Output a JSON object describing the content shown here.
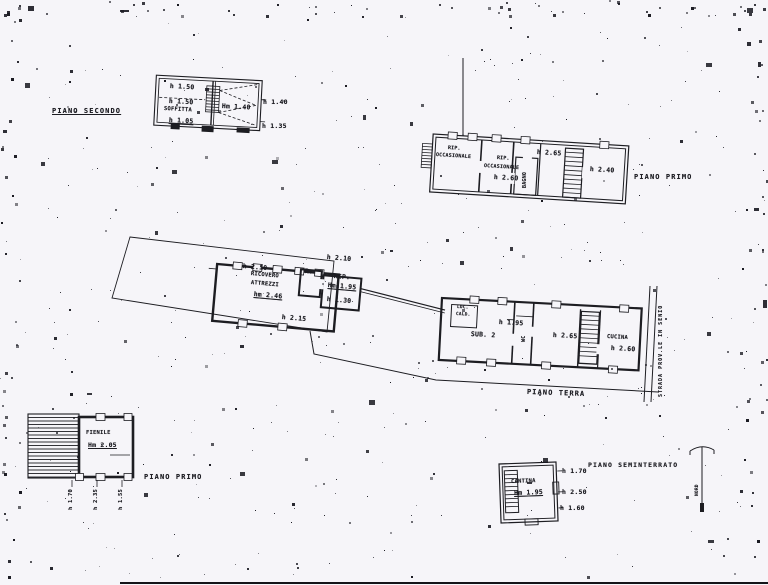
{
  "plans": {
    "secondo": {
      "title": "PIANO SECONDO",
      "soffitta": "SOFFITTA",
      "dim_top": "h 1.50",
      "dim_mid": "h 1.50",
      "dim_low": "h 1.05",
      "dim_hm": "Hm 1.40",
      "dim_right": "h 1.40",
      "dim_right_low": "h 1.35"
    },
    "primo": {
      "title": "PIANO PRIMO",
      "rip1_line1": "RIP.",
      "rip1_line2": "OCCASIONALE",
      "rip2_line1": "RIP.",
      "rip2_line2": "OCCASIONALE",
      "rip2_h": "h 2.60",
      "dim_265": "h 2.65",
      "bagno": "BAGNO",
      "dim_240": "h 2.40"
    },
    "terra": {
      "title": "PIANO TERRA",
      "dim_210_left": "h 2.10",
      "ricovero_line1": "RICOVERO",
      "ricovero_line2": "ATTREZZI",
      "ricovero_h": "hm 2.46",
      "room_r": "R.",
      "dim_210_right": "h 2.10",
      "rip": "RIP.",
      "rip_h": "Hm 1.95",
      "dim_130": "h 1.30",
      "dim_215": "h 2.15",
      "loc_line1": "LOC.",
      "loc_line2": "CALD.",
      "sub2": "SUB. 2",
      "dim_195": "h 1.95",
      "wc": "WC",
      "dim_265b": "h 2.65",
      "cucina": "CUCINA",
      "cucina_h": "h 2.60",
      "road": "STRADA PROV.LE IN SENIO"
    },
    "fienile": {
      "title": "PIANO PRIMO",
      "name": "FIENILE",
      "h": "Hm 2.05",
      "dim1": "h 1.70",
      "dim2": "h 2.35",
      "dim3": "h 1.55"
    },
    "seminterrato": {
      "title": "PIANO SEMINTERRATO",
      "name": "CANTINA",
      "h": "Hm 1.95",
      "dim1": "h 1.70",
      "dim2": "h 2.50",
      "dim3": "h 1.60",
      "north": "NORD"
    }
  }
}
